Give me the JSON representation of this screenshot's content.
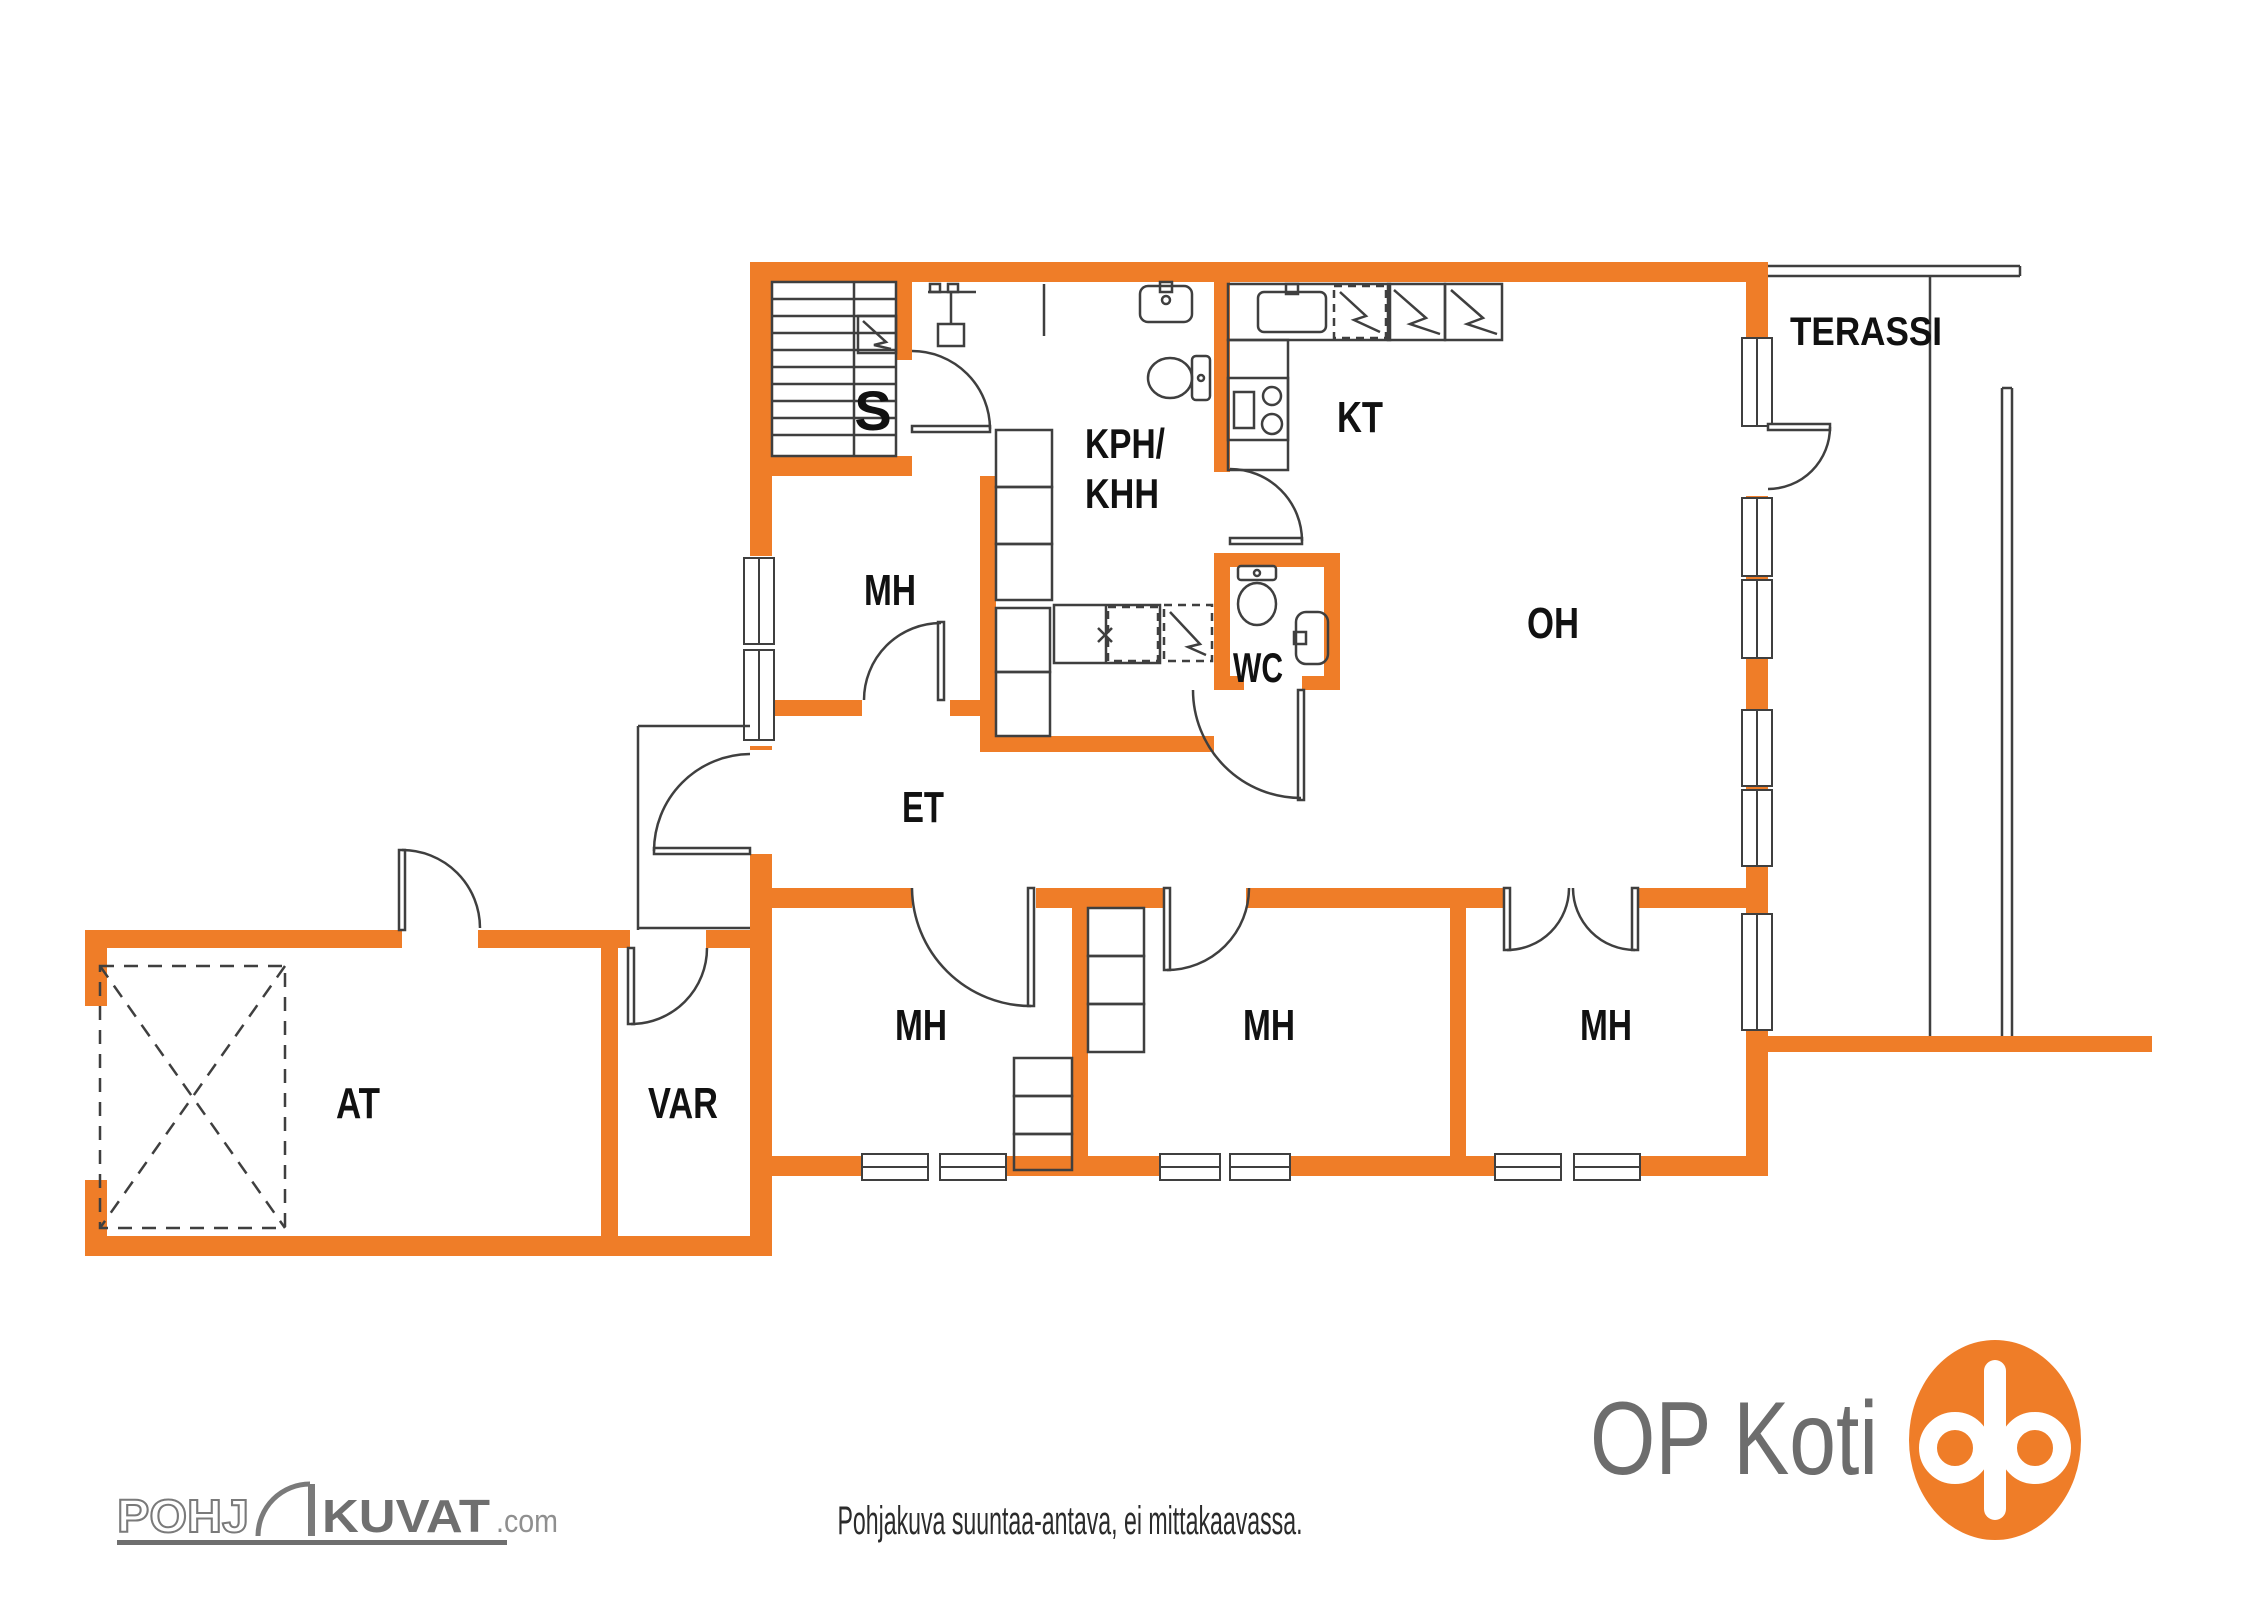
{
  "colors": {
    "wall": "#EF7D28",
    "line": "#3F3F3F",
    "label": "#111111",
    "brand_gray": "#6D6D6D",
    "watermark_gray": "#757575"
  },
  "rooms": [
    {
      "id": "sauna",
      "label": "S"
    },
    {
      "id": "bathroom-line1",
      "label": "KPH/"
    },
    {
      "id": "bathroom-line2",
      "label": "KHH"
    },
    {
      "id": "kitchen",
      "label": "KT"
    },
    {
      "id": "living-room",
      "label": "OH"
    },
    {
      "id": "wc",
      "label": "WC"
    },
    {
      "id": "bedroom-nw",
      "label": "MH"
    },
    {
      "id": "entry",
      "label": "ET"
    },
    {
      "id": "bedroom-s1",
      "label": "MH"
    },
    {
      "id": "bedroom-s2",
      "label": "MH"
    },
    {
      "id": "bedroom-s3",
      "label": "MH"
    },
    {
      "id": "garage",
      "label": "AT"
    },
    {
      "id": "storage",
      "label": "VAR"
    },
    {
      "id": "terrace",
      "label": "TERASSI"
    }
  ],
  "footer": {
    "disclaimer": "Pohjakuva suuntaa-antava, ei mittakaavassa.",
    "brand_text": "OP Koti",
    "watermark_prefix": "POHJ",
    "watermark_main": "KUVAT",
    "watermark_suffix": ".com"
  }
}
